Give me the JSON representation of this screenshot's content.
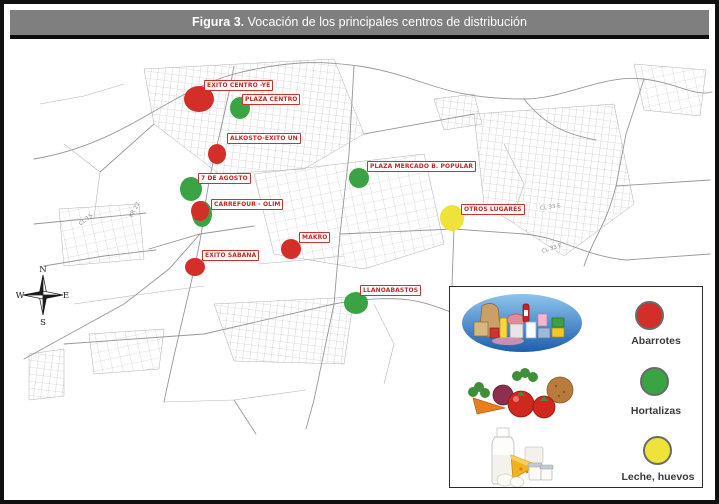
{
  "figure": {
    "title_prefix": "Figura 3.",
    "title_rest": " Vocación de los principales centros de distribución"
  },
  "categories": {
    "abarrotes": {
      "color": "#d42e29"
    },
    "hortalizas": {
      "color": "#3aa343"
    },
    "leche_huevos": {
      "color": "#efe33b"
    }
  },
  "map": {
    "markers": [
      {
        "label": "EXITO CENTRO -YE",
        "category": "abarrotes",
        "cx": 195,
        "cy": 95,
        "rx": 15,
        "ry": 13,
        "label_x": 200,
        "label_y": 76
      },
      {
        "label": "PLAZA CENTRO",
        "category": "hortalizas",
        "cx": 236,
        "cy": 104,
        "rx": 10,
        "ry": 11,
        "label_x": 238,
        "label_y": 90
      },
      {
        "label": "ALKOSTO-EXITO UN",
        "category": "abarrotes",
        "cx": 213,
        "cy": 150,
        "rx": 9,
        "ry": 10,
        "label_x": 223,
        "label_y": 129
      },
      {
        "label": "7 DE AGOSTO",
        "category": "hortalizas",
        "cx": 187,
        "cy": 185,
        "rx": 11,
        "ry": 12,
        "label_x": 194,
        "label_y": 169
      },
      {
        "label": "",
        "category": "hortalizas",
        "cx": 198,
        "cy": 210,
        "rx": 10,
        "ry": 13
      },
      {
        "label": "CARREFOUR - OLIM",
        "category": "abarrotes",
        "cx": 196,
        "cy": 207,
        "rx": 9,
        "ry": 10,
        "label_x": 207,
        "label_y": 195
      },
      {
        "label": "MAKRO",
        "category": "abarrotes",
        "cx": 287,
        "cy": 245,
        "rx": 10,
        "ry": 10,
        "label_x": 295,
        "label_y": 228
      },
      {
        "label": "EXITO SABANA",
        "category": "abarrotes",
        "cx": 191,
        "cy": 263,
        "rx": 10,
        "ry": 9,
        "label_x": 198,
        "label_y": 246
      },
      {
        "label": "PLAZA MERCADO B. POPULAR",
        "category": "hortalizas",
        "cx": 355,
        "cy": 174,
        "rx": 10,
        "ry": 10,
        "label_x": 363,
        "label_y": 157
      },
      {
        "label": "OTROS LUGARES",
        "category": "leche_huevos",
        "cx": 448,
        "cy": 214,
        "rx": 12,
        "ry": 13,
        "label_x": 457,
        "label_y": 200
      },
      {
        "label": "LLANOABASTOS",
        "category": "hortalizas",
        "cx": 352,
        "cy": 299,
        "rx": 12,
        "ry": 11,
        "label_x": 356,
        "label_y": 281
      }
    ],
    "street_labels": [
      {
        "text": "CL 33 E",
        "x": 536,
        "y": 202,
        "rotate": -8
      },
      {
        "text": "CL 33 E",
        "x": 538,
        "y": 245,
        "rotate": -18
      },
      {
        "text": "CL 15",
        "x": 76,
        "y": 218,
        "rotate": -38
      },
      {
        "text": "KR 27",
        "x": 127,
        "y": 210,
        "rotate": -60
      }
    ],
    "compass": {
      "north": "N",
      "south": "S",
      "east": "E",
      "west": "W"
    }
  },
  "legend": {
    "items": [
      {
        "label": "Abarrotes",
        "category": "abarrotes"
      },
      {
        "label": "Hortalizas",
        "category": "hortalizas"
      },
      {
        "label": "Leche, huevos",
        "category": "leche_huevos"
      }
    ]
  }
}
